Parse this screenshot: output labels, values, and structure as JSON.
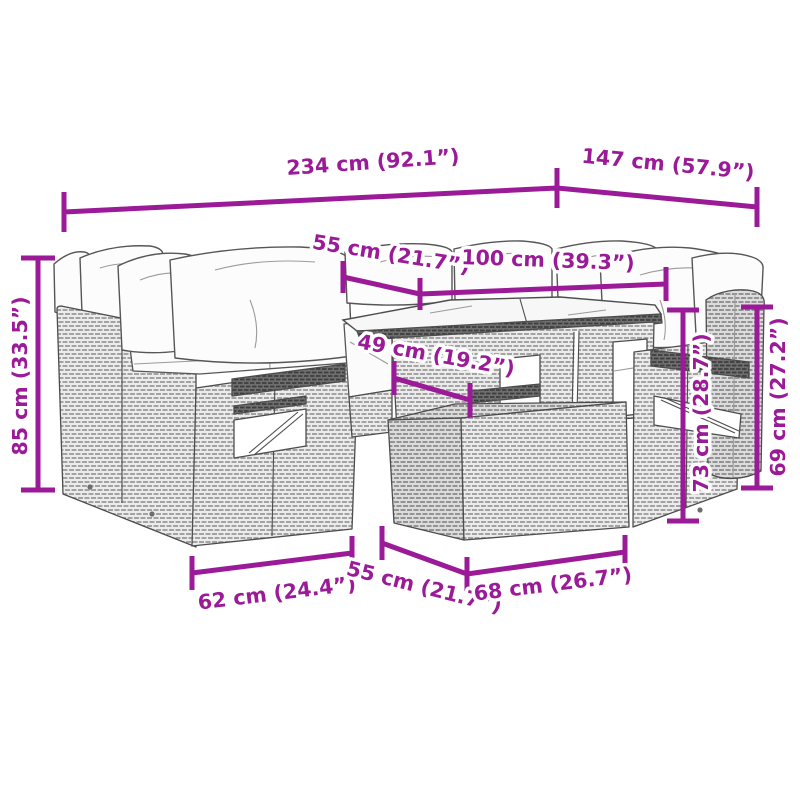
{
  "accent_color": "#9A1A97",
  "dims": {
    "overall_width": "234 cm (92.1”)",
    "overall_depth": "147 cm (57.9”)",
    "total_height": "85 cm (33.5”)",
    "back_width": "55 cm (21.7”)",
    "table_length_top": "100 cm (39.3”)",
    "seat_depth": "49 cm (19.2”)",
    "table_height": "73 cm (28.7”)",
    "arm_height": "69 cm (27.2”)",
    "module_width": "62 cm (24.4”)",
    "module_depth": "55 cm (21.7”)",
    "table_width": "68 cm (26.7”)"
  }
}
